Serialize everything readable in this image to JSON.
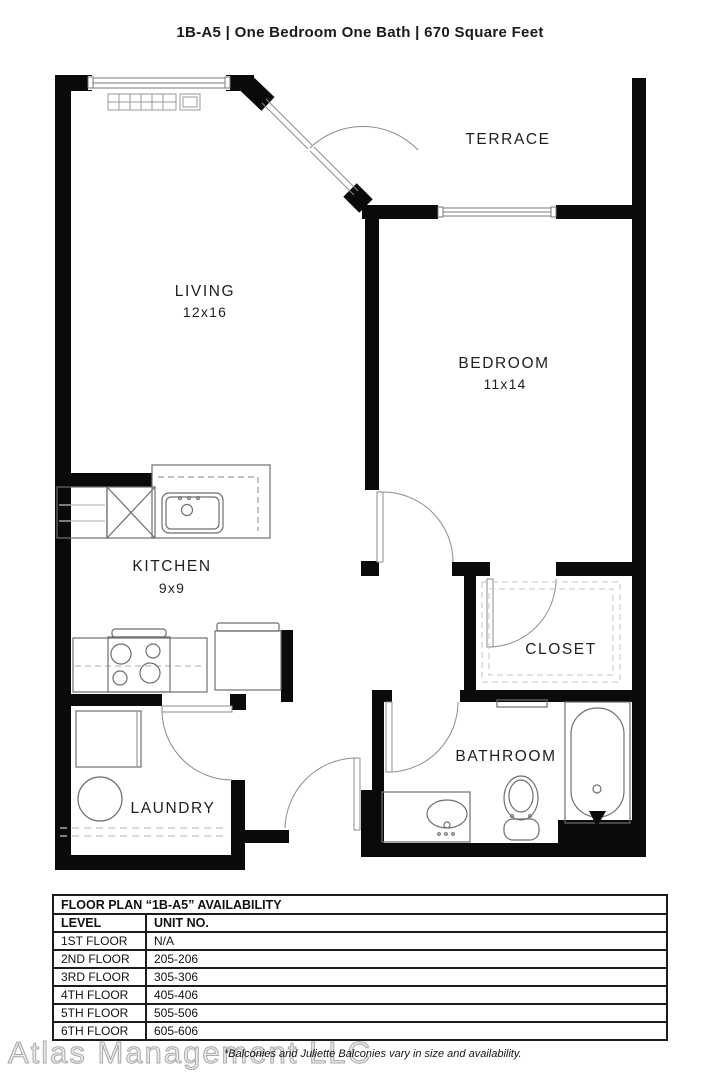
{
  "header": {
    "title": "1B-A5 | One Bedroom One Bath | 670 Square Feet"
  },
  "floor_plan": {
    "rooms": {
      "terrace": {
        "label": "TERRACE"
      },
      "living": {
        "label": "LIVING",
        "dimensions": "12x16"
      },
      "bedroom": {
        "label": "BEDROOM",
        "dimensions": "11x14"
      },
      "kitchen": {
        "label": "KITCHEN",
        "dimensions": "9x9"
      },
      "closet": {
        "label": "CLOSET"
      },
      "laundry": {
        "label": "LAUNDRY"
      },
      "bathroom": {
        "label": "BATHROOM"
      }
    }
  },
  "availability_table": {
    "title": "FLOOR PLAN “1B-A5” AVAILABILITY",
    "columns": [
      "LEVEL",
      "UNIT NO."
    ],
    "rows": [
      {
        "level": "1ST FLOOR",
        "unit": "N/A"
      },
      {
        "level": "2ND FLOOR",
        "unit": "205-206"
      },
      {
        "level": "3RD FLOOR",
        "unit": "305-306"
      },
      {
        "level": "4TH FLOOR",
        "unit": "405-406"
      },
      {
        "level": "5TH FLOOR",
        "unit": "505-506"
      },
      {
        "level": "6TH FLOOR",
        "unit": "605-606"
      }
    ]
  },
  "footer": {
    "watermark": "Atlas Management LLC",
    "note": "*Balconies and Juliette Balconies vary in size and availability."
  },
  "colors": {
    "wall": "#0a0a0a",
    "fixture_line": "#6e6e6e",
    "door_line": "#8d8d8d",
    "watermark": "#ececec"
  }
}
